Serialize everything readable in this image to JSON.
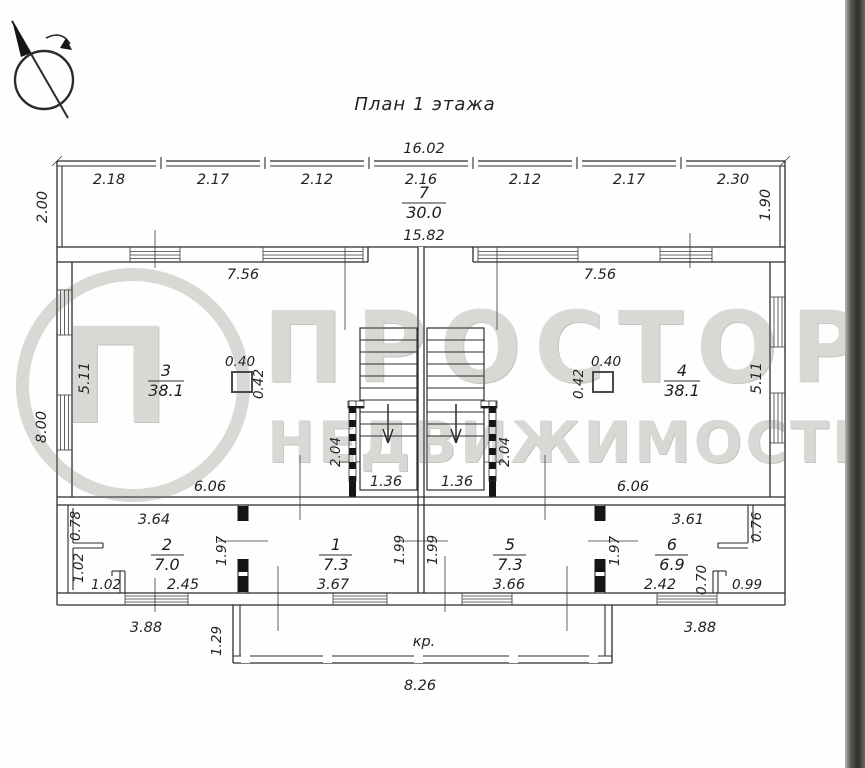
{
  "title": "План 1 этажа",
  "watermark": {
    "logo_letter": "П",
    "line1": "ПРОСТОР",
    "line2": "НЕДВИЖИМОСТЬ"
  },
  "overall": {
    "top_width": "16.02",
    "veranda_left": "2.00",
    "veranda_right": "1.90",
    "left_height": "8.00",
    "bottom_left_window": "3.88",
    "bottom_right_window": "3.88",
    "porch_label": "кр.",
    "porch_width": "8.26",
    "porch_depth": "1.29"
  },
  "veranda": {
    "number": "7",
    "area": "30.0",
    "inner_width": "15.82",
    "segments": [
      "2.18",
      "2.17",
      "2.12",
      "2.16",
      "2.12",
      "2.17",
      "2.30"
    ]
  },
  "room3": {
    "number": "3",
    "area": "38.1",
    "top": "7.56",
    "bottom": "6.06",
    "side": "5.11",
    "flue_w": "0.40",
    "flue_h": "0.42"
  },
  "room4": {
    "number": "4",
    "area": "38.1",
    "top": "7.56",
    "bottom": "6.06",
    "side": "5.11",
    "flue_w": "0.40",
    "flue_h": "0.42"
  },
  "stairs": {
    "left": {
      "width": "1.36",
      "height": "2.04"
    },
    "right": {
      "width": "1.36",
      "height": "2.04"
    }
  },
  "room1": {
    "number": "1",
    "area": "7.3",
    "bottom": "3.67",
    "side": "1.99"
  },
  "room2": {
    "number": "2",
    "area": "7.0",
    "top": "3.64",
    "bottom": "2.45",
    "side": "1.97",
    "left_top": "0.78",
    "left_mid": "1.02",
    "left_bottom": "1.02"
  },
  "room5": {
    "number": "5",
    "area": "7.3",
    "bottom": "3.66",
    "left": "1.99",
    "right": "1.97"
  },
  "room6": {
    "number": "6",
    "area": "6.9",
    "top": "3.61",
    "bottom": "2.42",
    "right_top": "0.76",
    "notch_h": "0.70",
    "notch_w": "0.99"
  }
}
